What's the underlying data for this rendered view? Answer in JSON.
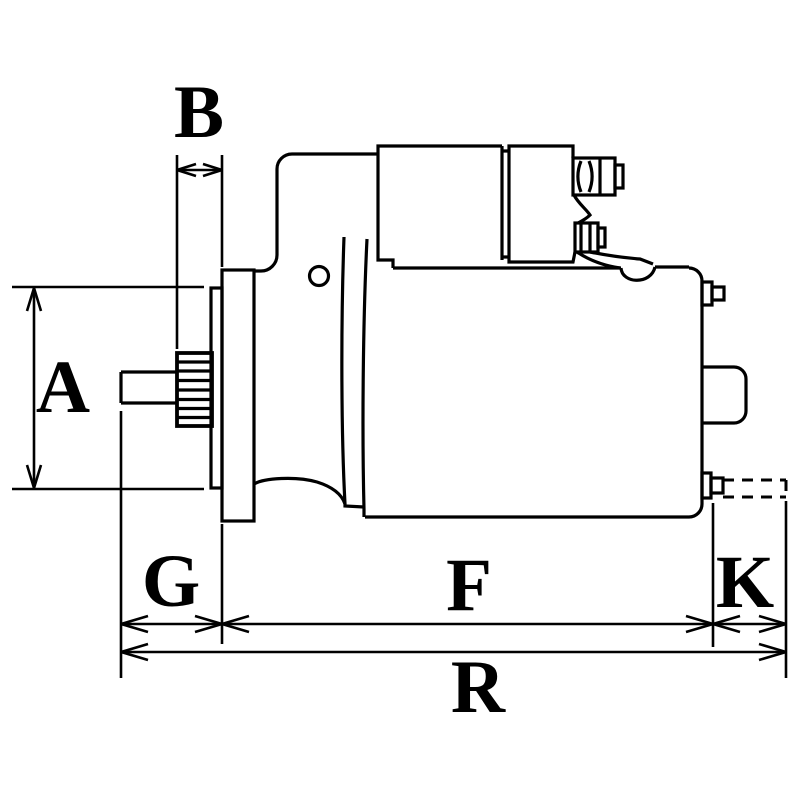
{
  "diagram": {
    "type": "technical-dimensional-drawing",
    "subject": "starter motor side view with dimension callouts",
    "colors": {
      "line": "#000000",
      "background": "#ffffff"
    }
  },
  "labels": {
    "A": "A",
    "B": "B",
    "G": "G",
    "F": "F",
    "K": "K",
    "R": "R"
  }
}
